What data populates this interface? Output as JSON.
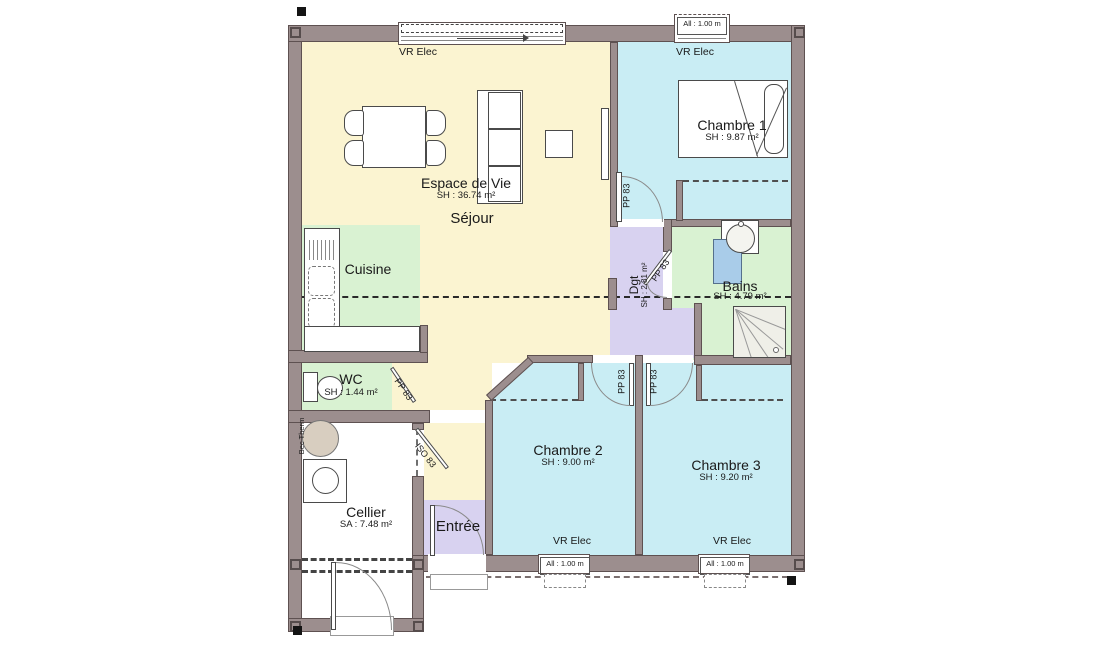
{
  "plan": {
    "rooms": {
      "espace_de_vie": {
        "name": "Espace de Vie",
        "area": "SH : 36.74 m²"
      },
      "sejour": {
        "name": "Séjour"
      },
      "cuisine": {
        "name": "Cuisine"
      },
      "chambre1": {
        "name": "Chambre 1",
        "area": "SH : 9.87 m²"
      },
      "chambre2": {
        "name": "Chambre 2",
        "area": "SH : 9.00 m²"
      },
      "chambre3": {
        "name": "Chambre 3",
        "area": "SH : 9.20 m²"
      },
      "bains": {
        "name": "Bains",
        "area": "SH : 4.79 m²"
      },
      "dgt": {
        "name": "Dgt",
        "area": "SH : 2.81 m²"
      },
      "wc": {
        "name": "WC",
        "area": "SH : 1.44 m²"
      },
      "cellier": {
        "name": "Cellier",
        "area": "SA : 7.48 m²"
      },
      "entree": {
        "name": "Entrée"
      }
    },
    "labels": {
      "vr_elec": "VR Elec",
      "allege": "All : 1.00 m",
      "pp83": "PP 83",
      "iso83": "ISO 83",
      "bec_therm": "Bec Therm"
    },
    "colors": {
      "wall": "#9c8e8e",
      "living": "#fbf4d1",
      "bedroom": "#c9edf4",
      "service": "#d9f2d2",
      "circulation": "#d8d2f0",
      "fixture_blue": "#a9cce9",
      "heater_tan": "#d8cec0"
    }
  }
}
